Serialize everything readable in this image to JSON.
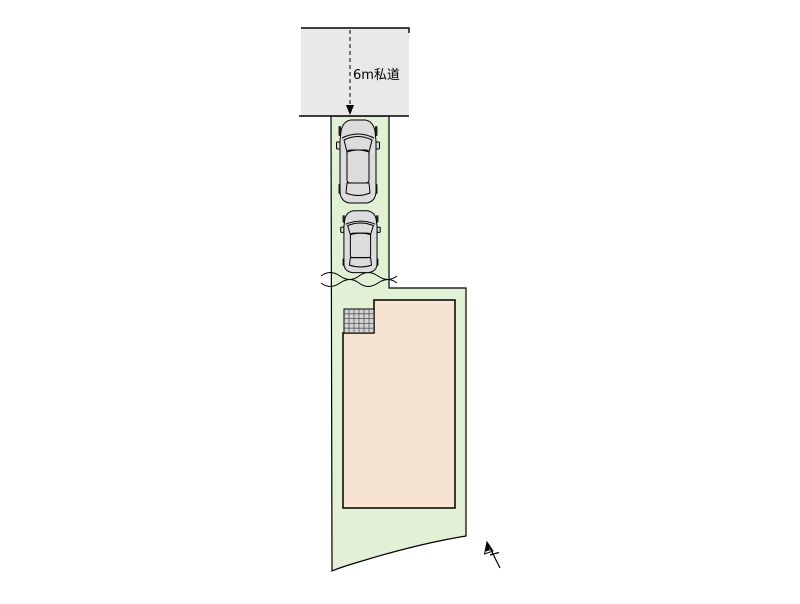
{
  "site_plan": {
    "road_label": "6m私道"
  },
  "icons": {
    "car": "car-top-view-icon",
    "north_arrow": "north-arrow-icon",
    "entrance_tile": "tile-grid-icon",
    "road_arrow": "dashed-down-arrow-icon"
  },
  "colors": {
    "background": "#ffffff",
    "road_fill": "#e9e9e9",
    "plot_fill": "#e2f0d5",
    "building_fill": "#f6e3d2",
    "tile_fill": "#d4d4d4",
    "car_fill": "#dcdcdc",
    "outline": "#000000"
  }
}
